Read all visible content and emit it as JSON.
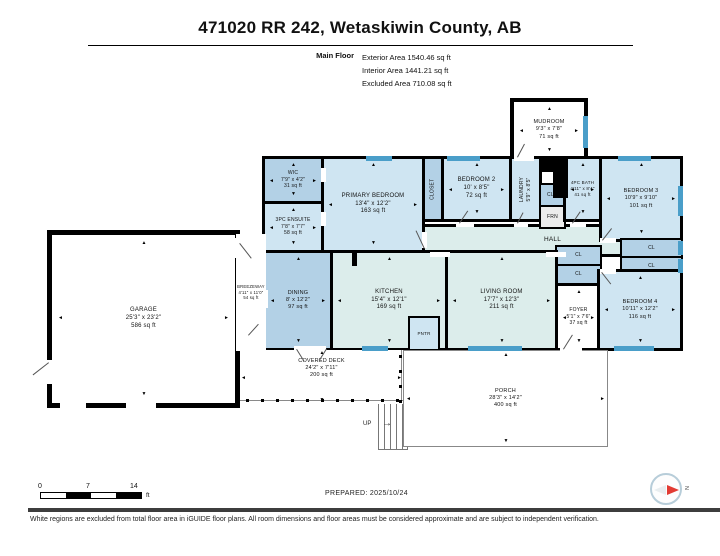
{
  "header": {
    "title": "471020 RR 242, Wetaskiwin County, AB",
    "floor_label": "Main Floor",
    "stats": [
      "Exterior Area 1540.46 sq ft",
      "Interior Area 1441.21 sq ft",
      "Excluded Area 710.08 sq ft"
    ]
  },
  "floorplan": {
    "colors": {
      "light": "#cfe5f2",
      "dark": "#b3d1e6",
      "pale": "#dcedeb",
      "white": "#ffffff",
      "gray": "#ececec",
      "window": "#4a9ec9"
    },
    "stairs_label": "UP",
    "stair_arrow": "→",
    "arrow_glyphs": {
      "t": "▲",
      "b": "▼",
      "l": "◄",
      "r": "►"
    },
    "rooms": [
      {
        "id": "hall",
        "name": "HALL",
        "x": 422,
        "y": 224,
        "w": 261,
        "h": 33,
        "fill": "pale",
        "bw": 3,
        "fs": 6.5
      },
      {
        "id": "mudroom",
        "name": "MUDROOM",
        "dims": "9'3\" x 7'8\"",
        "area": "71 sq ft",
        "x": 510,
        "y": 98,
        "w": 78,
        "h": 64,
        "fill": "white",
        "bw": 4,
        "fs": 5.5,
        "ar": true
      },
      {
        "id": "wic",
        "name": "WIC",
        "dims": "7'9\" x 4'2\"",
        "area": "31 sq ft",
        "x": 262,
        "y": 156,
        "w": 62,
        "h": 48,
        "fill": "dark",
        "bw": 3,
        "fs": 5,
        "ar": true
      },
      {
        "id": "ensuite-3pc",
        "name": "3PC ENSUITE",
        "dims": "7'8\" x 7'7\"",
        "area": "58 sq ft",
        "x": 262,
        "y": 201,
        "w": 62,
        "h": 52,
        "fill": "light",
        "bw": 3,
        "fs": 5,
        "ar": true
      },
      {
        "id": "primary-bedroom",
        "name": "PRIMARY BEDROOM",
        "dims": "13'4\" x 12'2\"",
        "area": "163 sq ft",
        "x": 321,
        "y": 156,
        "w": 104,
        "h": 97,
        "fill": "light",
        "bw": 3,
        "fs": 6,
        "ar": true
      },
      {
        "id": "closet",
        "name": "CLOSET",
        "x": 422,
        "y": 156,
        "w": 22,
        "h": 66,
        "fill": "dark",
        "bw": 3,
        "fs": 5,
        "vertical": true
      },
      {
        "id": "bedroom-2",
        "name": "BEDROOM 2",
        "dims": "10' x 8'5\"",
        "area": "72 sq ft",
        "x": 441,
        "y": 156,
        "w": 71,
        "h": 66,
        "fill": "light",
        "bw": 3,
        "fs": 6,
        "ar": true
      },
      {
        "id": "laundry",
        "name": "LAUNDRY",
        "dims": "5'9\" x 8'5\"",
        "x": 509,
        "y": 156,
        "w": 33,
        "h": 66,
        "fill": "light",
        "bw": 3,
        "fs": 5,
        "vertical": true
      },
      {
        "id": "clo",
        "name": "CLO",
        "x": 539,
        "y": 183,
        "w": 27,
        "h": 24,
        "fill": "dark",
        "bw": 2,
        "fs": 5
      },
      {
        "id": "frn",
        "name": "FRN",
        "x": 539,
        "y": 205,
        "w": 27,
        "h": 24,
        "fill": "gray",
        "bw": 2,
        "fs": 5
      },
      {
        "id": "bath-4pc",
        "name": "4PC BATH",
        "dims": "4'11\" x 8'4\"",
        "area": "41 sq ft",
        "x": 563,
        "y": 156,
        "w": 39,
        "h": 66,
        "fill": "light",
        "bw": 3,
        "fs": 4.5,
        "ar": true
      },
      {
        "id": "bedroom-3",
        "name": "BEDROOM 3",
        "dims": "10'9\" x 9'10\"",
        "area": "101 sq ft",
        "x": 599,
        "y": 156,
        "w": 84,
        "h": 86,
        "fill": "light",
        "bw": 3,
        "fs": 5.5,
        "ar": true
      },
      {
        "id": "cl-1",
        "name": "CL",
        "x": 620,
        "y": 238,
        "w": 63,
        "h": 20,
        "fill": "dark",
        "bw": 2,
        "fs": 5
      },
      {
        "id": "cl-2",
        "name": "CL",
        "x": 620,
        "y": 256,
        "w": 63,
        "h": 20,
        "fill": "dark",
        "bw": 2,
        "fs": 5
      },
      {
        "id": "cl-3",
        "name": "CL",
        "x": 555,
        "y": 245,
        "w": 47,
        "h": 21,
        "fill": "dark",
        "bw": 2,
        "fs": 5
      },
      {
        "id": "cl-4",
        "name": "CL",
        "x": 555,
        "y": 264,
        "w": 47,
        "h": 21,
        "fill": "dark",
        "bw": 2,
        "fs": 5
      },
      {
        "id": "foyer",
        "name": "FOYER",
        "dims": "5'1\" x 7'6\"",
        "area": "37 sq ft",
        "x": 555,
        "y": 283,
        "w": 47,
        "h": 68,
        "fill": "white",
        "bw": 3,
        "fs": 5,
        "ar": true
      },
      {
        "id": "bedroom-4",
        "name": "BEDROOM 4",
        "dims": "10'11\" x 12'2\"",
        "area": "116 sq ft",
        "x": 597,
        "y": 269,
        "w": 86,
        "h": 82,
        "fill": "light",
        "bw": 3,
        "fs": 5.5,
        "ar": true
      },
      {
        "id": "dining",
        "name": "DINING",
        "dims": "8' x 12'2\"",
        "area": "97 sq ft",
        "x": 263,
        "y": 250,
        "w": 70,
        "h": 101,
        "fill": "dark",
        "bw": 3,
        "fs": 5.5,
        "ar": true
      },
      {
        "id": "kitchen",
        "name": "KITCHEN",
        "dims": "15'4\" x 12'1\"",
        "area": "169 sq ft",
        "x": 330,
        "y": 250,
        "w": 118,
        "h": 101,
        "fill": "pale",
        "bw": 3,
        "fs": 6,
        "ar": true
      },
      {
        "id": "living-room",
        "name": "LIVING ROOM",
        "dims": "17'7\" x 12'3\"",
        "area": "211 sq ft",
        "x": 445,
        "y": 250,
        "w": 113,
        "h": 101,
        "fill": "pale",
        "bw": 3,
        "fs": 6,
        "ar": true
      },
      {
        "id": "pantry",
        "name": "PNTR",
        "x": 408,
        "y": 316,
        "w": 32,
        "h": 35,
        "fill": "light",
        "bw": 2,
        "fs": 4.5
      },
      {
        "id": "garage",
        "name": "GARAGE",
        "dims": "25'3\" x 23'2\"",
        "area": "586 sq ft",
        "x": 47,
        "y": 230,
        "w": 193,
        "h": 178,
        "fill": "white",
        "bw": 5,
        "fs": 6,
        "ar": true
      },
      {
        "id": "breezeway",
        "name": "BREEZEWAY",
        "dims": "4'11\" x 11'0\"",
        "area": "54 sq ft",
        "x": 236,
        "y": 234,
        "w": 30,
        "h": 117,
        "fill": "white",
        "bw": 0,
        "fs": 4.2
      },
      {
        "id": "covered-deck",
        "name": "COVERED DECK",
        "dims": "24'2\" x 7'11\"",
        "area": "200 sq ft",
        "x": 240,
        "y": 350,
        "w": 163,
        "h": 54,
        "fill": "white",
        "bw": 0,
        "fs": 5.5,
        "labelTop": true,
        "ar": true
      },
      {
        "id": "porch",
        "name": "PORCH",
        "dims": "28'3\" x 14'2\"",
        "area": "400 sq ft",
        "x": 403,
        "y": 350,
        "w": 205,
        "h": 97,
        "fill": "white",
        "bw": 1,
        "bc": "#888",
        "fs": 5.5,
        "ar": true
      }
    ],
    "steps": [
      {
        "x": 512,
        "y": 141,
        "w": 30,
        "h": 9
      },
      {
        "x": 512,
        "y": 149,
        "w": 30,
        "h": 9
      }
    ],
    "blocks": [
      {
        "x": 553,
        "y": 156,
        "w": 15,
        "h": 42
      },
      {
        "x": 539,
        "y": 156,
        "w": 17,
        "h": 16
      },
      {
        "x": 352,
        "y": 250,
        "w": 5,
        "h": 16
      }
    ],
    "windows": [
      {
        "x": 366,
        "y": 156,
        "w": 26,
        "h": 5
      },
      {
        "x": 447,
        "y": 156,
        "w": 33,
        "h": 5
      },
      {
        "x": 618,
        "y": 156,
        "w": 33,
        "h": 5
      },
      {
        "x": 583,
        "y": 116,
        "w": 5,
        "h": 32
      },
      {
        "x": 678,
        "y": 186,
        "w": 5,
        "h": 30
      },
      {
        "x": 678,
        "y": 241,
        "w": 5,
        "h": 14
      },
      {
        "x": 678,
        "y": 259,
        "w": 5,
        "h": 14
      },
      {
        "x": 468,
        "y": 346,
        "w": 54,
        "h": 5
      },
      {
        "x": 362,
        "y": 346,
        "w": 26,
        "h": 5
      },
      {
        "x": 614,
        "y": 346,
        "w": 40,
        "h": 5
      }
    ],
    "gaps": [
      {
        "x": 422,
        "y": 232,
        "w": 5,
        "h": 16
      },
      {
        "x": 321,
        "y": 168,
        "w": 5,
        "h": 14
      },
      {
        "x": 321,
        "y": 212,
        "w": 5,
        "h": 14
      },
      {
        "x": 456,
        "y": 222,
        "w": 18,
        "h": 5
      },
      {
        "x": 514,
        "y": 222,
        "w": 14,
        "h": 5
      },
      {
        "x": 570,
        "y": 222,
        "w": 16,
        "h": 5
      },
      {
        "x": 600,
        "y": 238,
        "w": 16,
        "h": 5
      },
      {
        "x": 430,
        "y": 252,
        "w": 20,
        "h": 5
      },
      {
        "x": 546,
        "y": 252,
        "w": 20,
        "h": 5
      },
      {
        "x": 600,
        "y": 269,
        "w": 16,
        "h": 5
      },
      {
        "x": 560,
        "y": 346,
        "w": 22,
        "h": 5
      },
      {
        "x": 294,
        "y": 346,
        "w": 32,
        "h": 5
      },
      {
        "x": 263,
        "y": 290,
        "w": 5,
        "h": 18
      },
      {
        "x": 60,
        "y": 403,
        "w": 26,
        "h": 5
      },
      {
        "x": 126,
        "y": 403,
        "w": 30,
        "h": 5
      },
      {
        "x": 47,
        "y": 360,
        "w": 5,
        "h": 24
      },
      {
        "x": 235,
        "y": 238,
        "w": 5,
        "h": 20
      },
      {
        "x": 514,
        "y": 156,
        "w": 20,
        "h": 5
      }
    ],
    "doors": [
      {
        "x": 424,
        "y": 249,
        "l": 20,
        "a": -115
      },
      {
        "x": 240,
        "y": 243,
        "l": 19,
        "a": 52
      },
      {
        "x": 248,
        "y": 335,
        "l": 15,
        "a": -48
      },
      {
        "x": 517,
        "y": 157,
        "l": 15,
        "a": -62
      },
      {
        "x": 459,
        "y": 223,
        "l": 15,
        "a": -56
      },
      {
        "x": 517,
        "y": 223,
        "l": 12,
        "a": -62
      },
      {
        "x": 572,
        "y": 223,
        "l": 14,
        "a": -56
      },
      {
        "x": 602,
        "y": 240,
        "l": 15,
        "a": -52
      },
      {
        "x": 602,
        "y": 272,
        "l": 15,
        "a": 52
      },
      {
        "x": 563,
        "y": 349,
        "l": 17,
        "a": -58
      },
      {
        "x": 297,
        "y": 349,
        "l": 14,
        "a": 58
      },
      {
        "x": 327,
        "y": 349,
        "l": 14,
        "a": 122
      },
      {
        "x": 49,
        "y": 363,
        "l": 20,
        "a": 142
      }
    ],
    "lines": [
      {
        "x": 240,
        "y": 400,
        "w": 163,
        "h": 1
      },
      {
        "x": 401,
        "y": 350,
        "w": 1,
        "h": 51
      }
    ],
    "posts": [
      {
        "x": 246,
        "y": 399,
        "dx": 15,
        "dy": 0,
        "count": 11
      },
      {
        "x": 399,
        "y": 355,
        "dx": 0,
        "dy": 15,
        "count": 4
      }
    ]
  },
  "scalebar": {
    "ticks": [
      "0",
      "7",
      "14"
    ],
    "unit": "ft"
  },
  "prepared_label": "PREPARED: 2025/10/24",
  "compass": {
    "letter": "N"
  },
  "footer": {
    "disclaimer": "White regions are excluded from total floor area in iGUIDE floor plans. All room dimensions and floor areas must be considered approximate and are subject to independent verification."
  }
}
